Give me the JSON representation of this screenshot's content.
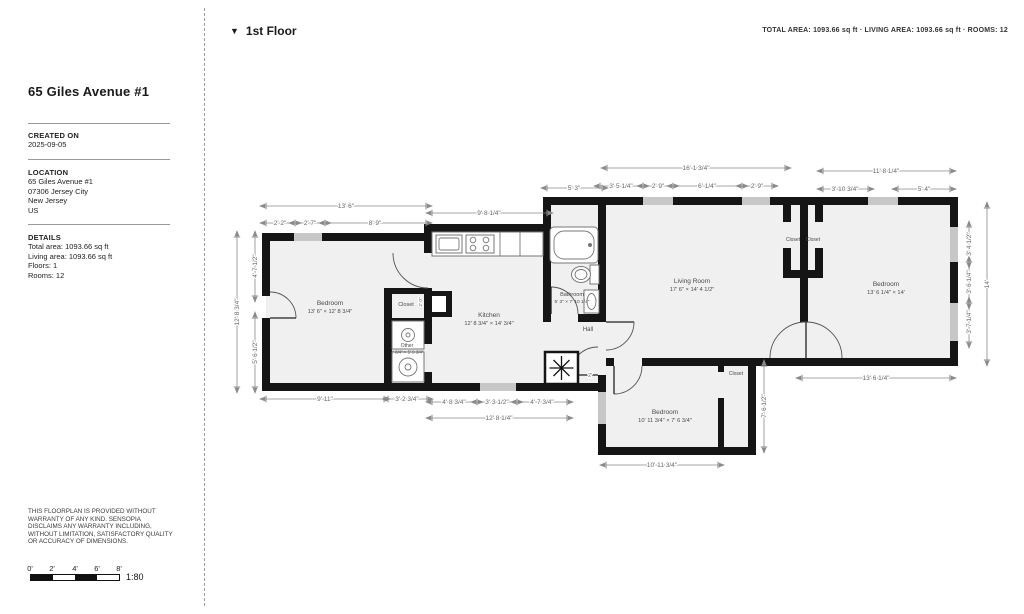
{
  "sidebar": {
    "title": "65 Giles Avenue #1",
    "created_label": "CREATED ON",
    "created_value": "2025-09-05",
    "location_label": "LOCATION",
    "location_lines": "65 Giles Avenue #1\n07306 Jersey City\nNew Jersey\nUS",
    "details_label": "DETAILS",
    "details_lines": "Total area: 1093.66 sq ft\nLiving area: 1093.66 sq ft\nFloors: 1\nRooms: 12",
    "disclaimer": "THIS FLOORPLAN IS PROVIDED WITHOUT\nWARRANTY OF ANY KIND. SENSOPIA\nDISCLAIMS ANY WARRANTY INCLUDING,\nWITHOUT LIMITATION, SATISFACTORY QUALITY\nOR ACCURACY OF DIMENSIONS."
  },
  "header": {
    "floor_icon": "▼",
    "floor_label": "1st Floor",
    "summary": "TOTAL AREA: 1093.66 sq ft · LIVING AREA: 1093.66 sq ft · ROOMS: 12"
  },
  "scale": {
    "labels": [
      "0'",
      "2'",
      "4'",
      "6'",
      "8'"
    ],
    "ratio": "1:80"
  },
  "floorplan": {
    "fixtures": [
      "bathtub",
      "toilet",
      "sink",
      "kitchen-counter",
      "stove",
      "washer",
      "dryer",
      "ac-unit",
      "duct"
    ],
    "rooms": [
      {
        "name": "Bedroom",
        "size": "13' 6\" × 12' 8 3/4\"",
        "x": 330,
        "y": 305,
        "s": 6.5
      },
      {
        "name": "Closet",
        "size": "",
        "x": 406,
        "y": 306,
        "s": 5.5
      },
      {
        "name": "Other",
        "size": "2' 3/4\" × 5' 9 3/4\"",
        "x": 407,
        "y": 347,
        "s": 5
      },
      {
        "name": "Kitchen",
        "size": "12' 8 3/4\" × 14' 3/4\"",
        "x": 489,
        "y": 317,
        "s": 6.5
      },
      {
        "name": "Bathroom",
        "size": "5' 3\" × 7' 10 1/4\"",
        "x": 572,
        "y": 296,
        "s": 5.5
      },
      {
        "name": "Hall",
        "size": "",
        "x": 588,
        "y": 331,
        "s": 6
      },
      {
        "name": "Living Room",
        "size": "17' 6\" × 14' 4 1/2\"",
        "x": 692,
        "y": 283,
        "s": 6.5
      },
      {
        "name": "Closet",
        "size": "",
        "x": 793,
        "y": 241,
        "s": 5
      },
      {
        "name": "Closet",
        "size": "",
        "x": 813,
        "y": 241,
        "s": 5
      },
      {
        "name": "Bedroom",
        "size": "13' 6 1/4\" × 14'",
        "x": 886,
        "y": 286,
        "s": 6.5
      },
      {
        "name": "Bedroom",
        "size": "10' 11 3/4\" × 7' 6 3/4\"",
        "x": 665,
        "y": 414,
        "s": 6.5
      },
      {
        "name": "Closet",
        "size": "",
        "x": 736,
        "y": 375,
        "s": 5
      }
    ],
    "dimensions": [
      {
        "t": "13' 6\"",
        "x": 346,
        "y": 208
      },
      {
        "t": "2' 2\"",
        "x": 280,
        "y": 225
      },
      {
        "t": "2' 7\"",
        "x": 310,
        "y": 225
      },
      {
        "t": "8' 9\"",
        "x": 375,
        "y": 225
      },
      {
        "t": "9' 8 1/4\"",
        "x": 489,
        "y": 215
      },
      {
        "t": "5' 3\"",
        "x": 574,
        "y": 190
      },
      {
        "t": "16' 1 3/4\"",
        "x": 696,
        "y": 170
      },
      {
        "t": "3' 5 1/4\"",
        "x": 621,
        "y": 188
      },
      {
        "t": "2' 9\"",
        "x": 658,
        "y": 188
      },
      {
        "t": "6' 1/4\"",
        "x": 707,
        "y": 188
      },
      {
        "t": "2' 9\"",
        "x": 757,
        "y": 188
      },
      {
        "t": "11' 8 1/4\"",
        "x": 886,
        "y": 173
      },
      {
        "t": "3' 10 3/4\"",
        "x": 845,
        "y": 191
      },
      {
        "t": "5' 4\"",
        "x": 924,
        "y": 191
      },
      {
        "t": "12' 8 3/4\"",
        "x": 239,
        "y": 312,
        "r": -90
      },
      {
        "t": "4' 7 1/2\"",
        "x": 257,
        "y": 266,
        "r": -90
      },
      {
        "t": "5' 6 1/2\"",
        "x": 257,
        "y": 352,
        "r": -90
      },
      {
        "t": "3' 4 1/2\"",
        "x": 971,
        "y": 244,
        "r": -90
      },
      {
        "t": "3' 6 1/4\"",
        "x": 971,
        "y": 282,
        "r": -90
      },
      {
        "t": "3' 7 1/4\"",
        "x": 971,
        "y": 322,
        "r": -90
      },
      {
        "t": "14'",
        "x": 989,
        "y": 284,
        "r": -90
      },
      {
        "t": "7' 6 1/2\"",
        "x": 766,
        "y": 406,
        "r": -90
      },
      {
        "t": "2' 0\"",
        "x": 422,
        "y": 302,
        "r": -90,
        "s": 4.8
      },
      {
        "t": "9' 11\"",
        "x": 325,
        "y": 401
      },
      {
        "t": "3' 2 3/4\"",
        "x": 407,
        "y": 401
      },
      {
        "t": "4' 8 3/4\"",
        "x": 454,
        "y": 404
      },
      {
        "t": "3' 3 1/2\"",
        "x": 497,
        "y": 404
      },
      {
        "t": "4' 7 3/4\"",
        "x": 542,
        "y": 404
      },
      {
        "t": "12' 8 1/4\"",
        "x": 499,
        "y": 420
      },
      {
        "t": "10' 11 3/4\"",
        "x": 662,
        "y": 467
      },
      {
        "t": "13' 6 1/4\"",
        "x": 876,
        "y": 380
      },
      {
        "t": "2'",
        "x": 590,
        "y": 377,
        "s": 5.5
      }
    ]
  }
}
